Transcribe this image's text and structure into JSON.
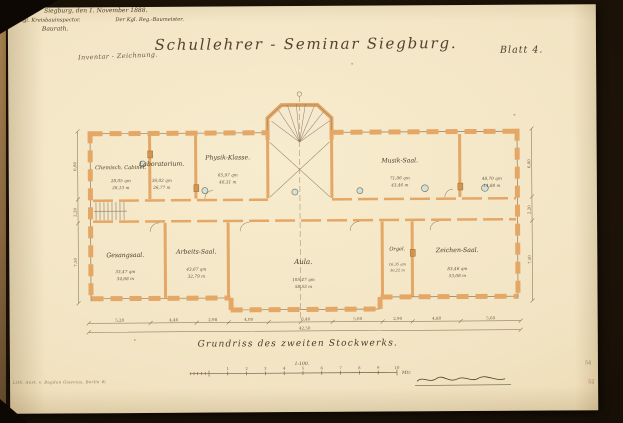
{
  "header": {
    "classification": "Inventar - Zeichnung.",
    "title": "Schullehrer - Seminar Siegburg.",
    "sheet": "Blatt 4."
  },
  "caption": {
    "text": "Grundriss des zweiten Stockwerks.",
    "scale": "1:100.",
    "scale_numbers": [
      "1",
      "2",
      "3",
      "4",
      "5",
      "6",
      "7",
      "8",
      "9",
      "10"
    ],
    "scale_unit": "Mtr."
  },
  "signature": {
    "place_date": "Siegburg, den 1. November 1888.",
    "left_title": "Der Kgl. Kreisbauinspector.",
    "right_title": "Der Kgl. Reg.-Baumeister.",
    "left_name": "Baurath."
  },
  "plan": {
    "rooms": [
      {
        "name": "Chemisch. Cabinet.",
        "area": "28,05 qm",
        "vol": "26,13 m"
      },
      {
        "name": "Laboratorium.",
        "area": "36,02 qm",
        "vol": "26,77 m"
      },
      {
        "name": "Physik-Klasse.",
        "area": "65,97 qm",
        "vol": "46,31 m"
      },
      {
        "name": "Musik-Saal.",
        "area": "71,06 qm",
        "vol": "43,46 m"
      },
      {
        "name": "",
        "area": "48,70 qm",
        "vol": "14,88 m"
      },
      {
        "name": "Gesangsaal.",
        "area": "33,47 qm",
        "vol": "34,68 m"
      },
      {
        "name": "Arbeits-Saal.",
        "area": "43,67 qm",
        "vol": "32,79 m"
      },
      {
        "name": "Aula.",
        "area": "105,47 qm",
        "vol": "58,53 m"
      },
      {
        "name": "Orgel.",
        "area": "16,35 qm",
        "vol": "30,22 m"
      },
      {
        "name": "Zeichen-Saal.",
        "area": "83,46 qm",
        "vol": "53,08 m"
      }
    ],
    "dims": {
      "bottom": [
        "5,20",
        "4,46",
        "2,98",
        "4,00",
        "6,40",
        "5,00",
        "2,90",
        "4,80",
        "5,60"
      ],
      "total": "42,50",
      "left": [
        "6,80",
        "2,20",
        "7,50"
      ],
      "right": [
        "6,80",
        "2,20",
        "7,50"
      ]
    }
  },
  "footer": {
    "print_line": "Lith. Anst. v. Bogdan Gisevius, Berlin W."
  },
  "margin": {
    "numbers": [
      "54",
      "52"
    ]
  },
  "colors": {
    "paper": "#f2e4c3",
    "wall": "#e4a766",
    "ink": "#4c3c2a",
    "dim_ink": "#6e5c42",
    "backdrop": "#181007",
    "oven": "#cfe3de"
  }
}
